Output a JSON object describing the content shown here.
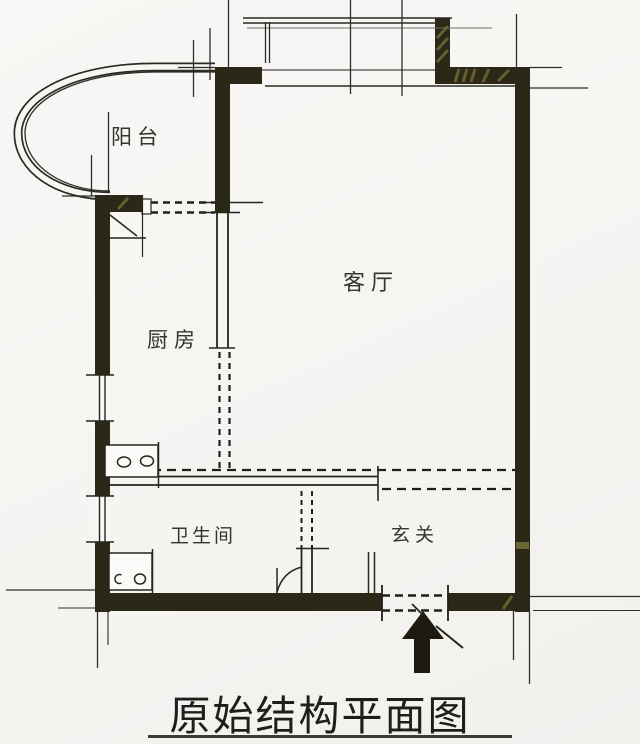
{
  "diagram": {
    "title": "原始结构平面图",
    "rooms": {
      "balcony": {
        "label": "阳台"
      },
      "kitchen": {
        "label": "厨房"
      },
      "living_room": {
        "label": "客厅"
      },
      "bathroom": {
        "label": "卫生间"
      },
      "entrance_hall": {
        "label": "玄关"
      }
    },
    "entrance": {
      "symbol": "entrance-arrow",
      "direction": "up"
    },
    "colors": {
      "wall": "#2b2817",
      "line": "#26261f",
      "hatch": "#6e6933",
      "background": "#f7f6f3",
      "text": "#35332c"
    }
  }
}
